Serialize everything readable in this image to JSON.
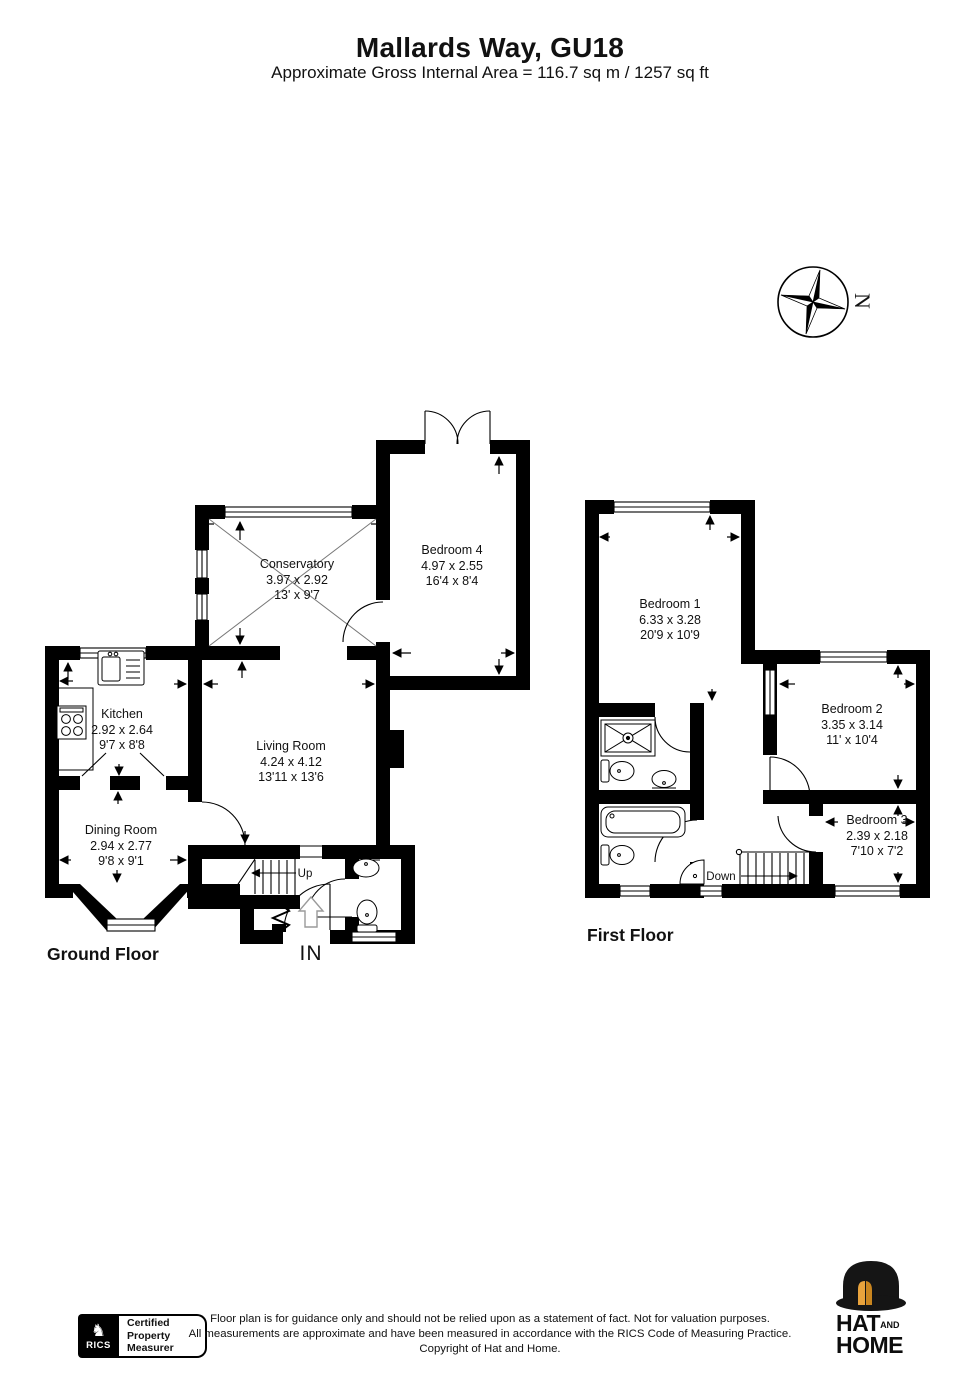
{
  "header": {
    "title": "Mallards Way, GU18",
    "subtitle": "Approximate Gross Internal Area = 116.7 sq m / 1257 sq ft"
  },
  "compass": {
    "north_label": "N"
  },
  "ground_floor": {
    "label": "Ground Floor",
    "stairs_label": "Up",
    "entrance_label": "IN",
    "rooms": [
      {
        "name": "Conservatory",
        "metric": "3.97 x 2.92",
        "imperial": "13' x 9'7"
      },
      {
        "name": "Bedroom 4",
        "metric": "4.97 x 2.55",
        "imperial": "16'4 x 8'4"
      },
      {
        "name": "Kitchen",
        "metric": "2.92 x 2.64",
        "imperial": "9'7 x 8'8"
      },
      {
        "name": "Living Room",
        "metric": "4.24 x 4.12",
        "imperial": "13'11 x 13'6"
      },
      {
        "name": "Dining Room",
        "metric": "2.94 x 2.77",
        "imperial": "9'8 x 9'1"
      }
    ]
  },
  "first_floor": {
    "label": "First Floor",
    "stairs_label": "Down",
    "rooms": [
      {
        "name": "Bedroom 1",
        "metric": "6.33 x 3.28",
        "imperial": "20'9 x 10'9"
      },
      {
        "name": "Bedroom 2",
        "metric": "3.35 x 3.14",
        "imperial": "11' x 10'4"
      },
      {
        "name": "Bedroom 3",
        "metric": "2.39 x 2.18",
        "imperial": "7'10 x 7'2"
      }
    ]
  },
  "footer": {
    "rics_logo": {
      "brand": "RICS",
      "knight_icon": "♞"
    },
    "badge": {
      "line1": "Certified",
      "line2": "Property",
      "line3": "Measurer"
    },
    "disclaimer": {
      "line1": "Floor plan is for guidance only and should not be relied upon as a statement of fact. Not for valuation purposes.",
      "line2": "All measurements are approximate and have been measured in accordance with the RICS Code of Measuring Practice.",
      "line3": "Copyright of Hat and Home."
    },
    "agency_logo": {
      "word1": "HAT",
      "conj": "AND",
      "word2": "HOME"
    }
  },
  "colors": {
    "wall": "#000000",
    "hat_gold": "#e8a33d",
    "background": "#ffffff"
  }
}
